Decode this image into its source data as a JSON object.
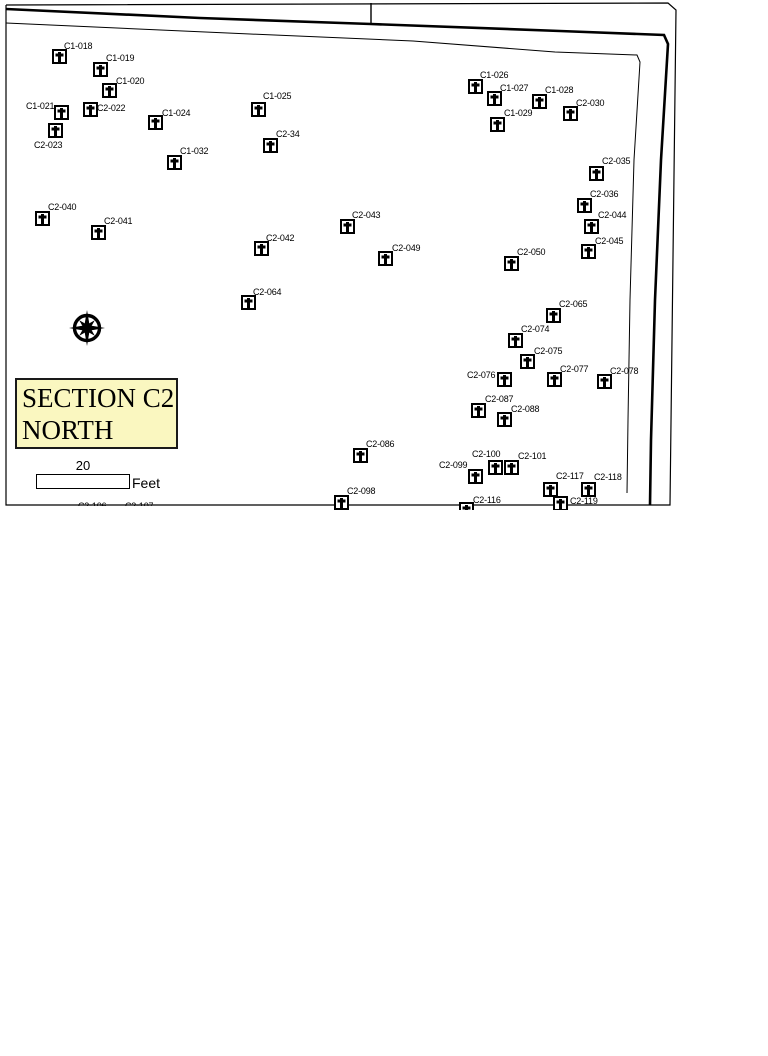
{
  "map": {
    "title_line1": "SECTION C2",
    "title_line2": "NORTH",
    "title_bg": "#faf7c0",
    "scale": {
      "value": "20",
      "unit": "Feet"
    },
    "marker_color": "#000000",
    "graves": [
      {
        "id": "C1-018",
        "x": 59,
        "y": 56,
        "lx": 64,
        "ly": 41
      },
      {
        "id": "C1-019",
        "x": 100,
        "y": 69,
        "lx": 106,
        "ly": 53
      },
      {
        "id": "C1-020",
        "x": 109,
        "y": 90,
        "lx": 116,
        "ly": 76
      },
      {
        "id": "C1-021",
        "x": 61,
        "y": 112,
        "lx": 26,
        "ly": 101
      },
      {
        "id": "C2-022",
        "x": 90,
        "y": 109,
        "lx": 97,
        "ly": 103
      },
      {
        "id": "C2-023",
        "x": 55,
        "y": 130,
        "lx": 34,
        "ly": 140
      },
      {
        "id": "C1-024",
        "x": 155,
        "y": 122,
        "lx": 162,
        "ly": 108
      },
      {
        "id": "C1-025",
        "x": 258,
        "y": 109,
        "lx": 263,
        "ly": 91
      },
      {
        "id": "C2-34",
        "x": 270,
        "y": 145,
        "lx": 276,
        "ly": 129
      },
      {
        "id": "C1-032",
        "x": 174,
        "y": 162,
        "lx": 180,
        "ly": 146
      },
      {
        "id": "C1-026",
        "x": 475,
        "y": 86,
        "lx": 480,
        "ly": 70
      },
      {
        "id": "C1-027",
        "x": 494,
        "y": 98,
        "lx": 500,
        "ly": 83
      },
      {
        "id": "C1-028",
        "x": 539,
        "y": 101,
        "lx": 545,
        "ly": 85
      },
      {
        "id": "C1-029",
        "x": 497,
        "y": 124,
        "lx": 504,
        "ly": 108
      },
      {
        "id": "C2-030",
        "x": 570,
        "y": 113,
        "lx": 576,
        "ly": 98
      },
      {
        "id": "C2-035",
        "x": 596,
        "y": 173,
        "lx": 602,
        "ly": 156
      },
      {
        "id": "C2-036",
        "x": 584,
        "y": 205,
        "lx": 590,
        "ly": 189
      },
      {
        "id": "C2-040",
        "x": 42,
        "y": 218,
        "lx": 48,
        "ly": 202
      },
      {
        "id": "C2-041",
        "x": 98,
        "y": 232,
        "lx": 104,
        "ly": 216
      },
      {
        "id": "C2-043",
        "x": 347,
        "y": 226,
        "lx": 352,
        "ly": 210
      },
      {
        "id": "C2-042",
        "x": 261,
        "y": 248,
        "lx": 266,
        "ly": 233
      },
      {
        "id": "C2-044",
        "x": 591,
        "y": 226,
        "lx": 598,
        "ly": 210
      },
      {
        "id": "C2-045",
        "x": 588,
        "y": 251,
        "lx": 595,
        "ly": 236
      },
      {
        "id": "C2-049",
        "x": 385,
        "y": 258,
        "lx": 392,
        "ly": 243
      },
      {
        "id": "C2-050",
        "x": 511,
        "y": 263,
        "lx": 517,
        "ly": 247
      },
      {
        "id": "C2-064",
        "x": 248,
        "y": 302,
        "lx": 253,
        "ly": 287
      },
      {
        "id": "C2-065",
        "x": 553,
        "y": 315,
        "lx": 559,
        "ly": 299
      },
      {
        "id": "C2-074",
        "x": 515,
        "y": 340,
        "lx": 521,
        "ly": 324
      },
      {
        "id": "C2-075",
        "x": 527,
        "y": 361,
        "lx": 534,
        "ly": 346
      },
      {
        "id": "C2-076",
        "x": 504,
        "y": 379,
        "lx": 467,
        "ly": 370
      },
      {
        "id": "C2-077",
        "x": 554,
        "y": 379,
        "lx": 560,
        "ly": 364
      },
      {
        "id": "C2-078",
        "x": 604,
        "y": 381,
        "lx": 610,
        "ly": 366
      },
      {
        "id": "C2-087",
        "x": 478,
        "y": 410,
        "lx": 485,
        "ly": 394
      },
      {
        "id": "C2-088",
        "x": 504,
        "y": 419,
        "lx": 511,
        "ly": 404
      },
      {
        "id": "C2-086",
        "x": 360,
        "y": 455,
        "lx": 366,
        "ly": 439
      },
      {
        "id": "C2-100",
        "x": 495,
        "y": 467,
        "lx": 472,
        "ly": 449
      },
      {
        "id": "C2-101",
        "x": 511,
        "y": 467,
        "lx": 518,
        "ly": 451
      },
      {
        "id": "C2-099",
        "x": 475,
        "y": 476,
        "lx": 439,
        "ly": 460
      },
      {
        "id": "C2-117",
        "x": 550,
        "y": 489,
        "lx": 556,
        "ly": 471
      },
      {
        "id": "C2-118",
        "x": 588,
        "y": 489,
        "lx": 594,
        "ly": 472
      },
      {
        "id": "C2-098",
        "x": 341,
        "y": 502,
        "lx": 347,
        "ly": 486
      },
      {
        "id": "C2-116",
        "x": 466,
        "y": 509,
        "lx": 473,
        "ly": 495
      },
      {
        "id": "C2-119",
        "x": 560,
        "y": 503,
        "lx": 570,
        "ly": 496
      }
    ],
    "partial_labels": [
      {
        "text": "C2-106",
        "x": 78,
        "y": 501
      },
      {
        "text": "C2-107",
        "x": 125,
        "y": 501
      }
    ],
    "boundary": {
      "outer": [
        [
          6,
          5
        ],
        [
          668,
          3
        ],
        [
          676,
          10
        ],
        [
          670,
          505
        ],
        [
          6,
          505
        ],
        [
          6,
          5
        ]
      ],
      "thick": [
        [
          6,
          9
        ],
        [
          200,
          18
        ],
        [
          371,
          24
        ],
        [
          560,
          31
        ],
        [
          664,
          35
        ],
        [
          668,
          44
        ],
        [
          661,
          160
        ],
        [
          655,
          300
        ],
        [
          651,
          440
        ],
        [
          650,
          505
        ]
      ],
      "inner": [
        [
          6,
          23
        ],
        [
          250,
          34
        ],
        [
          413,
          41
        ],
        [
          555,
          52
        ],
        [
          637,
          55
        ],
        [
          640,
          62
        ],
        [
          634,
          160
        ],
        [
          630,
          300
        ],
        [
          628,
          420
        ],
        [
          627,
          493
        ]
      ],
      "tick": [
        [
          371,
          3
        ],
        [
          371,
          24
        ]
      ]
    },
    "compass": {
      "cx": 87,
      "cy": 328
    }
  }
}
